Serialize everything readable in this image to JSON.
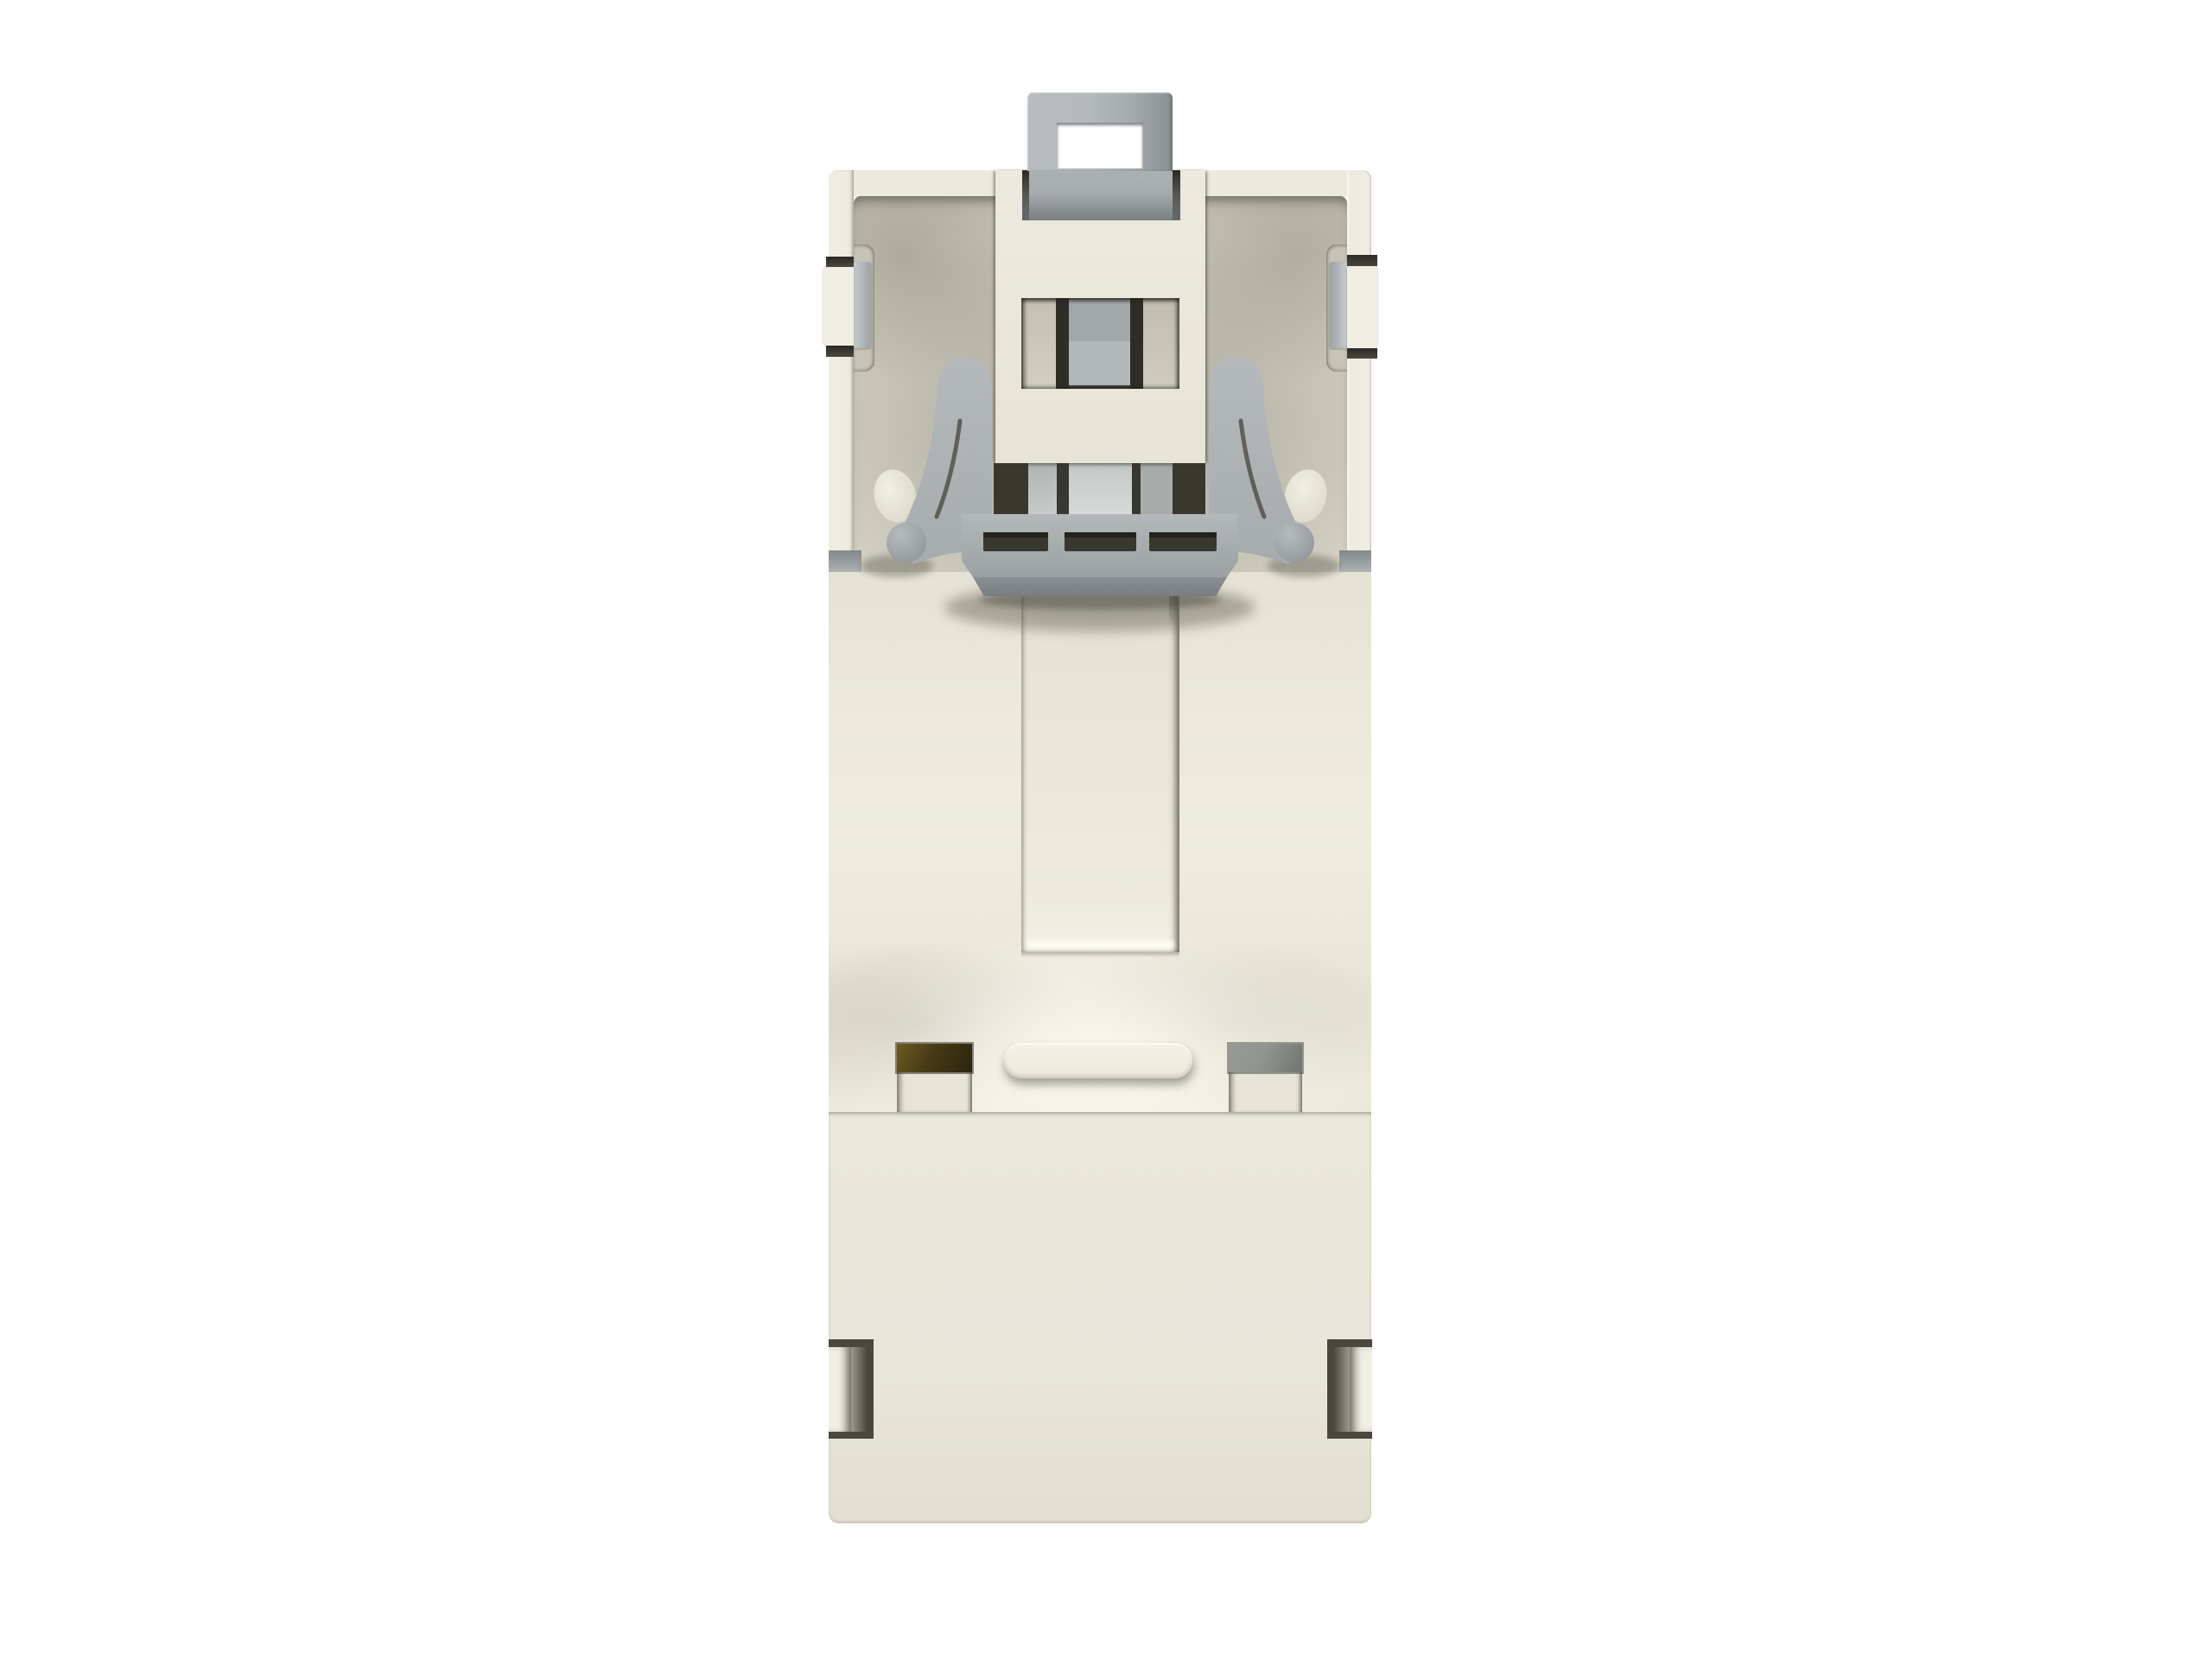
{
  "scene": {
    "description": "3D render of a cream plastic DIN-rail adapter housing (rear view) with gray metal rail clip and spring latch, on a white background",
    "text_content": "none"
  },
  "colors": {
    "background": "#ffffff",
    "body_cream": "#ece9dd",
    "body_cream_bright": "#f1eee3",
    "body_cream_dim": "#e1ddd0",
    "panel_cream": "#eae7db",
    "cavity_base": "#cfcbbe",
    "cavity_shadow": "#aeaa9e",
    "gray_light": "#b4b9bb",
    "gray_mid": "#a6acae",
    "gray_dark": "#8c9295",
    "gray_deep": "#787e81",
    "slot_dark": "#39382f",
    "slot_deep": "#23221c",
    "brown_light": "#6e5a21",
    "brown_dark": "#2d2410",
    "holegray_light": "#92958f",
    "holegray_dark": "#717570",
    "frame_dark": "#4a473e"
  },
  "parts": [
    {
      "id": "housing-body",
      "label": "cream housing body"
    },
    {
      "id": "din-clip-tab",
      "label": "gray rail clip tab with rectangular hole"
    },
    {
      "id": "release-latch",
      "label": "gray spring latch with curved arms and three slots"
    },
    {
      "id": "contact-window",
      "label": "central window with contact ribs"
    },
    {
      "id": "slider-channel",
      "label": "recessed vertical slider channel"
    },
    {
      "id": "cable-slot-left",
      "label": "dark amber cable slot"
    },
    {
      "id": "cable-slot-right",
      "label": "gray cable slot"
    },
    {
      "id": "pill-emboss",
      "label": "raised pill-shaped boss"
    },
    {
      "id": "snap-bracket-left",
      "label": "left snap bracket cutout"
    },
    {
      "id": "snap-bracket-right",
      "label": "right snap bracket cutout"
    }
  ]
}
